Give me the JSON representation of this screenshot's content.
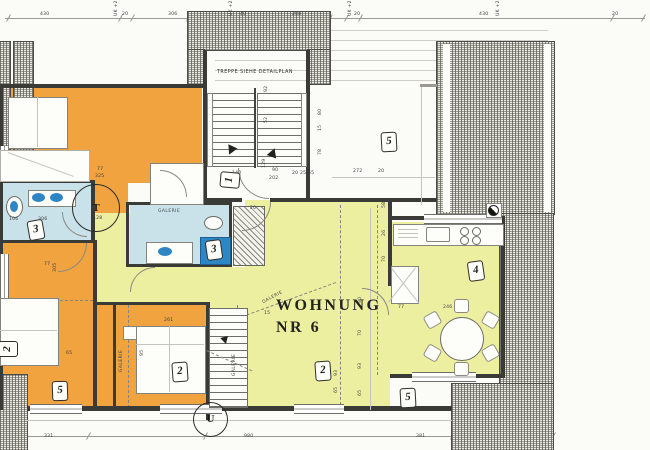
{
  "texts": {
    "apartment_line1": "WOHNUNG",
    "apartment_line2": "NR 6",
    "stairs_note": "TREPPE SIEHE DETAILPLAN",
    "galerie": "GALERIE",
    "marker_t": "T",
    "marker_u": "U"
  },
  "colors": {
    "orange": "#F1A33F",
    "cyan": "#C9E2E9",
    "blue": "#2F86C4",
    "yellow": "#ECEFA0",
    "wall": "#3A3A36",
    "paper": "#FBFBF7"
  },
  "room_tags": [
    {
      "label": "1",
      "x": 222,
      "y": 170,
      "rot": -85
    },
    {
      "label": "2",
      "x": 172,
      "y": 362,
      "rot": -4
    },
    {
      "label": "2",
      "x": 315,
      "y": 361,
      "rot": -4
    },
    {
      "label": "2",
      "x": 0,
      "y": 339,
      "rot": -90
    },
    {
      "label": "3",
      "x": 28,
      "y": 220,
      "rot": -10
    },
    {
      "label": "3",
      "x": 206,
      "y": 240,
      "rot": -8
    },
    {
      "label": "4",
      "x": 468,
      "y": 261,
      "rot": -8
    },
    {
      "label": "5",
      "x": 381,
      "y": 132,
      "rot": -3
    },
    {
      "label": "5",
      "x": 52,
      "y": 381,
      "rot": -2
    },
    {
      "label": "5",
      "x": 400,
      "y": 388,
      "rot": -3
    }
  ],
  "galerie_labels": [
    {
      "x": 158,
      "y": 210,
      "rot": 0
    },
    {
      "x": 120,
      "y": 372,
      "rot": -90
    },
    {
      "x": 233,
      "y": 376,
      "rot": -90
    },
    {
      "x": 262,
      "y": 296,
      "rot": -28
    }
  ],
  "dim_labels": [
    {
      "t": "430",
      "x": 40,
      "y": 12
    },
    {
      "t": "20",
      "x": 122,
      "y": 12
    },
    {
      "t": "306",
      "x": 168,
      "y": 12
    },
    {
      "t": "40",
      "x": 240,
      "y": 12
    },
    {
      "t": "208",
      "x": 292,
      "y": 12
    },
    {
      "t": "20",
      "x": 354,
      "y": 12
    },
    {
      "t": "430",
      "x": 479,
      "y": 12
    },
    {
      "t": "20",
      "x": 612,
      "y": 12
    },
    {
      "t": "UK +2.50",
      "x": 114,
      "y": 16,
      "v": 1
    },
    {
      "t": "UK +2.50",
      "x": 229,
      "y": 16,
      "v": 1
    },
    {
      "t": "UK +2.50",
      "x": 348,
      "y": 16,
      "v": 1
    },
    {
      "t": "UK +2.50",
      "x": 496,
      "y": 16,
      "v": 1
    },
    {
      "t": "331",
      "x": 44,
      "y": 434
    },
    {
      "t": "980",
      "x": 244,
      "y": 434
    },
    {
      "t": "381",
      "x": 416,
      "y": 434
    },
    {
      "t": "77",
      "x": 97,
      "y": 167
    },
    {
      "t": "325",
      "x": 95,
      "y": 174
    },
    {
      "t": "128",
      "x": 93,
      "y": 216
    },
    {
      "t": "106",
      "x": 9,
      "y": 217
    },
    {
      "t": "306",
      "x": 38,
      "y": 217
    },
    {
      "t": "140",
      "x": 232,
      "y": 171
    },
    {
      "t": "90",
      "x": 272,
      "y": 168
    },
    {
      "t": "202",
      "x": 269,
      "y": 176
    },
    {
      "t": "129",
      "x": 262,
      "y": 168,
      "v": 1
    },
    {
      "t": "20",
      "x": 292,
      "y": 171
    },
    {
      "t": "25",
      "x": 300,
      "y": 171
    },
    {
      "t": "65",
      "x": 308,
      "y": 171
    },
    {
      "t": "272",
      "x": 353,
      "y": 169
    },
    {
      "t": "20",
      "x": 378,
      "y": 169
    },
    {
      "t": "92",
      "x": 264,
      "y": 92,
      "v": 1
    },
    {
      "t": "52",
      "x": 264,
      "y": 123,
      "v": 1
    },
    {
      "t": "80",
      "x": 318,
      "y": 115,
      "v": 1
    },
    {
      "t": "15",
      "x": 318,
      "y": 131,
      "v": 1
    },
    {
      "t": "78",
      "x": 318,
      "y": 155,
      "v": 1
    },
    {
      "t": "90",
      "x": 358,
      "y": 303,
      "v": 1
    },
    {
      "t": "70",
      "x": 358,
      "y": 336,
      "v": 1
    },
    {
      "t": "93",
      "x": 358,
      "y": 369,
      "v": 1
    },
    {
      "t": "65",
      "x": 358,
      "y": 396,
      "v": 1
    },
    {
      "t": "58",
      "x": 382,
      "y": 208,
      "v": 1
    },
    {
      "t": "26",
      "x": 382,
      "y": 236,
      "v": 1
    },
    {
      "t": "70",
      "x": 382,
      "y": 262,
      "v": 1
    },
    {
      "t": "77",
      "x": 398,
      "y": 305
    },
    {
      "t": "246",
      "x": 443,
      "y": 305
    },
    {
      "t": "77",
      "x": 44,
      "y": 262
    },
    {
      "t": "305",
      "x": 53,
      "y": 272,
      "v": 1
    },
    {
      "t": "65",
      "x": 66,
      "y": 351
    },
    {
      "t": "261",
      "x": 164,
      "y": 318
    },
    {
      "t": "95",
      "x": 140,
      "y": 356,
      "v": 1
    },
    {
      "t": "93",
      "x": 334,
      "y": 376,
      "v": 1
    },
    {
      "t": "65",
      "x": 334,
      "y": 393,
      "v": 1
    },
    {
      "t": "20",
      "x": 250,
      "y": 206
    },
    {
      "t": "15",
      "x": 264,
      "y": 311
    }
  ]
}
